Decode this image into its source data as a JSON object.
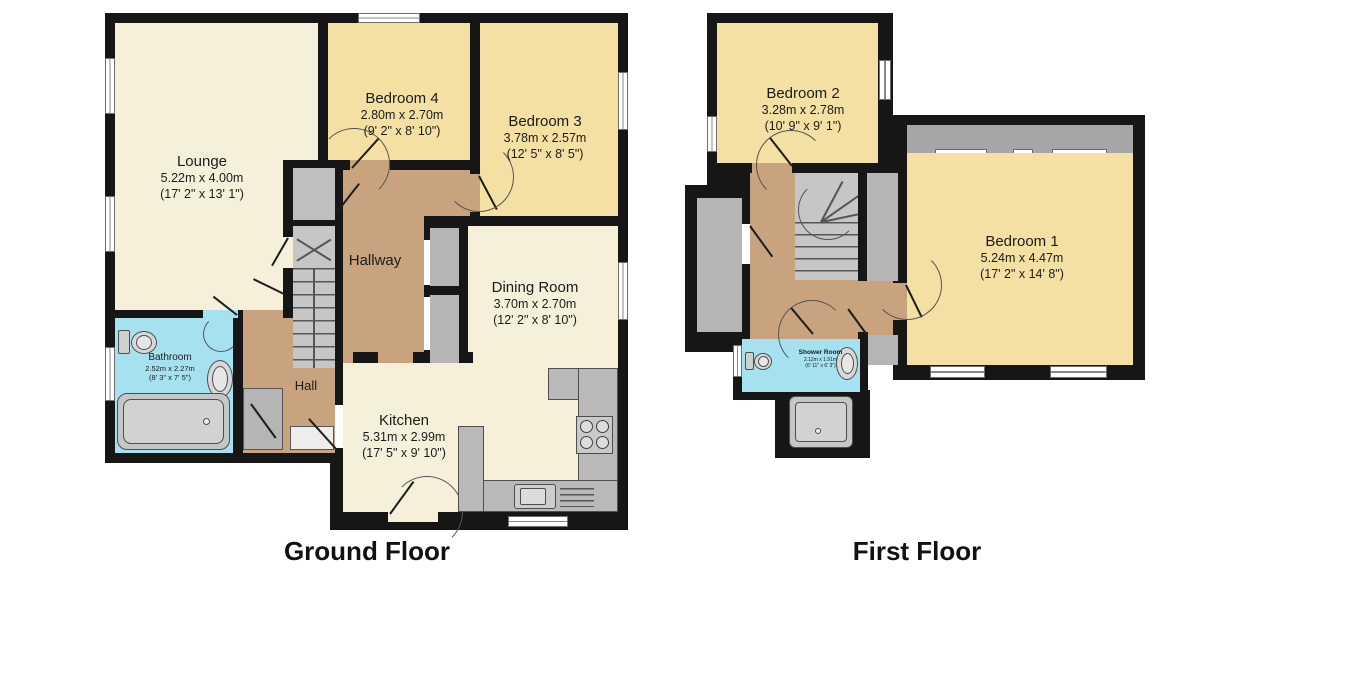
{
  "titles": {
    "ground": "Ground Floor",
    "first": "First Floor"
  },
  "ground": {
    "lounge": {
      "name": "Lounge",
      "metric": "5.22m x 4.00m",
      "imperial": "(17' 2\" x 13' 1\")"
    },
    "bedroom4": {
      "name": "Bedroom 4",
      "metric": "2.80m x 2.70m",
      "imperial": "(9' 2\" x 8' 10\")"
    },
    "bedroom3": {
      "name": "Bedroom 3",
      "metric": "3.78m x 2.57m",
      "imperial": "(12' 5\" x 8' 5\")"
    },
    "dining": {
      "name": "Dining Room",
      "metric": "3.70m x 2.70m",
      "imperial": "(12' 2\" x 8' 10\")"
    },
    "hallway": {
      "name": "Hallway"
    },
    "hall": {
      "name": "Hall"
    },
    "bathroom": {
      "name": "Bathroom",
      "metric": "2.52m x 2.27m",
      "imperial": "(8' 3\" x 7' 5\")"
    },
    "kitchen": {
      "name": "Kitchen",
      "metric": "5.31m x 2.99m",
      "imperial": "(17' 5\" x 9' 10\")"
    }
  },
  "first": {
    "bedroom2": {
      "name": "Bedroom 2",
      "metric": "3.28m x 2.78m",
      "imperial": "(10' 9\" x 9' 1\")"
    },
    "bedroom1": {
      "name": "Bedroom 1",
      "metric": "5.24m x 4.47m",
      "imperial": "(17' 2\" x 14' 8\")"
    },
    "shower": {
      "name": "Shower Room",
      "metric": "2.12m x 1.91m",
      "imperial": "(6' 11\" x 6' 3\")"
    }
  },
  "colors": {
    "wall": "#161616",
    "cream": "#f6f0da",
    "yellow": "#f3e0a2",
    "tan": "#c8a37d",
    "blue": "#a6e1f0",
    "gray": "#b5b5b5",
    "stair": "#c6c6c6",
    "fix": "#cfcfcf",
    "line": "#555555"
  }
}
